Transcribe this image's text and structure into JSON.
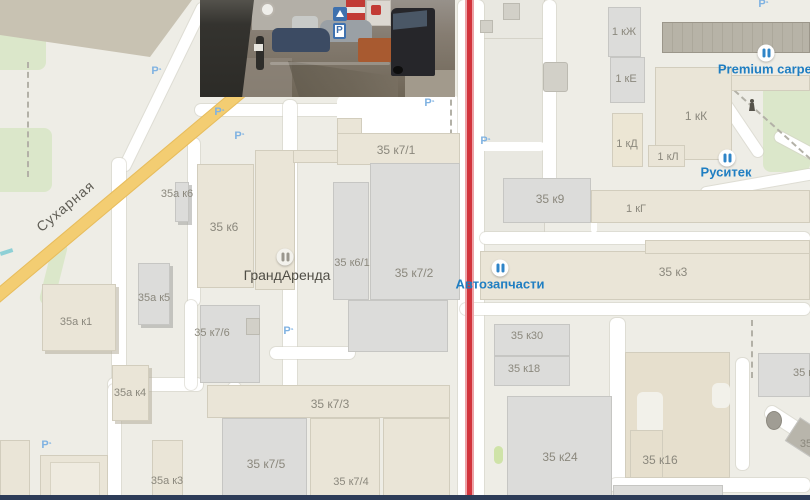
{
  "map": {
    "street": {
      "label": "Сухарная"
    },
    "building_labels": [
      {
        "t": "35 к7/1",
        "x": 396,
        "y": 150
      },
      {
        "t": "35 к6",
        "x": 224,
        "y": 227
      },
      {
        "t": "35 к6/1",
        "x": 352,
        "y": 263,
        "s": 11
      },
      {
        "t": "35 к7/2",
        "x": 414,
        "y": 273
      },
      {
        "t": "35а к6",
        "x": 177,
        "y": 194,
        "s": 11
      },
      {
        "t": "35а к5",
        "x": 154,
        "y": 298,
        "s": 11
      },
      {
        "t": "35а к1",
        "x": 76,
        "y": 322,
        "s": 11
      },
      {
        "t": "35а к4",
        "x": 130,
        "y": 393,
        "s": 11
      },
      {
        "t": "35 к7/6",
        "x": 212,
        "y": 333,
        "s": 11
      },
      {
        "t": "35 к7/3",
        "x": 330,
        "y": 404
      },
      {
        "t": "35 к7/5",
        "x": 266,
        "y": 464
      },
      {
        "t": "35 к7/4",
        "x": 351,
        "y": 482,
        "s": 11
      },
      {
        "t": "35а к3",
        "x": 167,
        "y": 481,
        "s": 11
      },
      {
        "t": "35 к9",
        "x": 550,
        "y": 199
      },
      {
        "t": "1 кГ",
        "x": 636,
        "y": 209,
        "s": 11
      },
      {
        "t": "1 кЖ",
        "x": 624,
        "y": 32,
        "s": 11
      },
      {
        "t": "1 кЕ",
        "x": 626,
        "y": 79,
        "s": 11
      },
      {
        "t": "1 кК",
        "x": 696,
        "y": 116
      },
      {
        "t": "1 кД",
        "x": 627,
        "y": 144,
        "s": 11
      },
      {
        "t": "1 кЛ",
        "x": 668,
        "y": 157,
        "s": 11
      },
      {
        "t": "35 к3",
        "x": 673,
        "y": 272
      },
      {
        "t": "35 к30",
        "x": 527,
        "y": 336,
        "s": 11
      },
      {
        "t": "35 к18",
        "x": 524,
        "y": 369,
        "s": 11
      },
      {
        "t": "35 к24",
        "x": 560,
        "y": 457
      },
      {
        "t": "35 к16",
        "x": 660,
        "y": 460
      },
      {
        "t": "35 к",
        "x": 803,
        "y": 373,
        "s": 11
      },
      {
        "t": "35",
        "x": 806,
        "y": 444,
        "s": 11
      }
    ],
    "pois": [
      {
        "label": "ГрандАренда"
      },
      {
        "label": "Автозапчасти"
      },
      {
        "label": "Premium carpet"
      },
      {
        "label": "Руситек"
      }
    ],
    "parking_label": "P",
    "parkings": [
      [
        155,
        71
      ],
      [
        218,
        112
      ],
      [
        238,
        136
      ],
      [
        428,
        103
      ],
      [
        484,
        141
      ],
      [
        287,
        331
      ],
      [
        45,
        445
      ],
      [
        762,
        4
      ]
    ],
    "colors": {
      "route_red": "#d2333c",
      "poi_blue": "#1f7ec2",
      "label_gray": "#8b887d",
      "road_yellow": "#f3cd72",
      "bottom_bar": "#2d3c58"
    }
  },
  "photo": {
    "parking_sign": "P"
  }
}
